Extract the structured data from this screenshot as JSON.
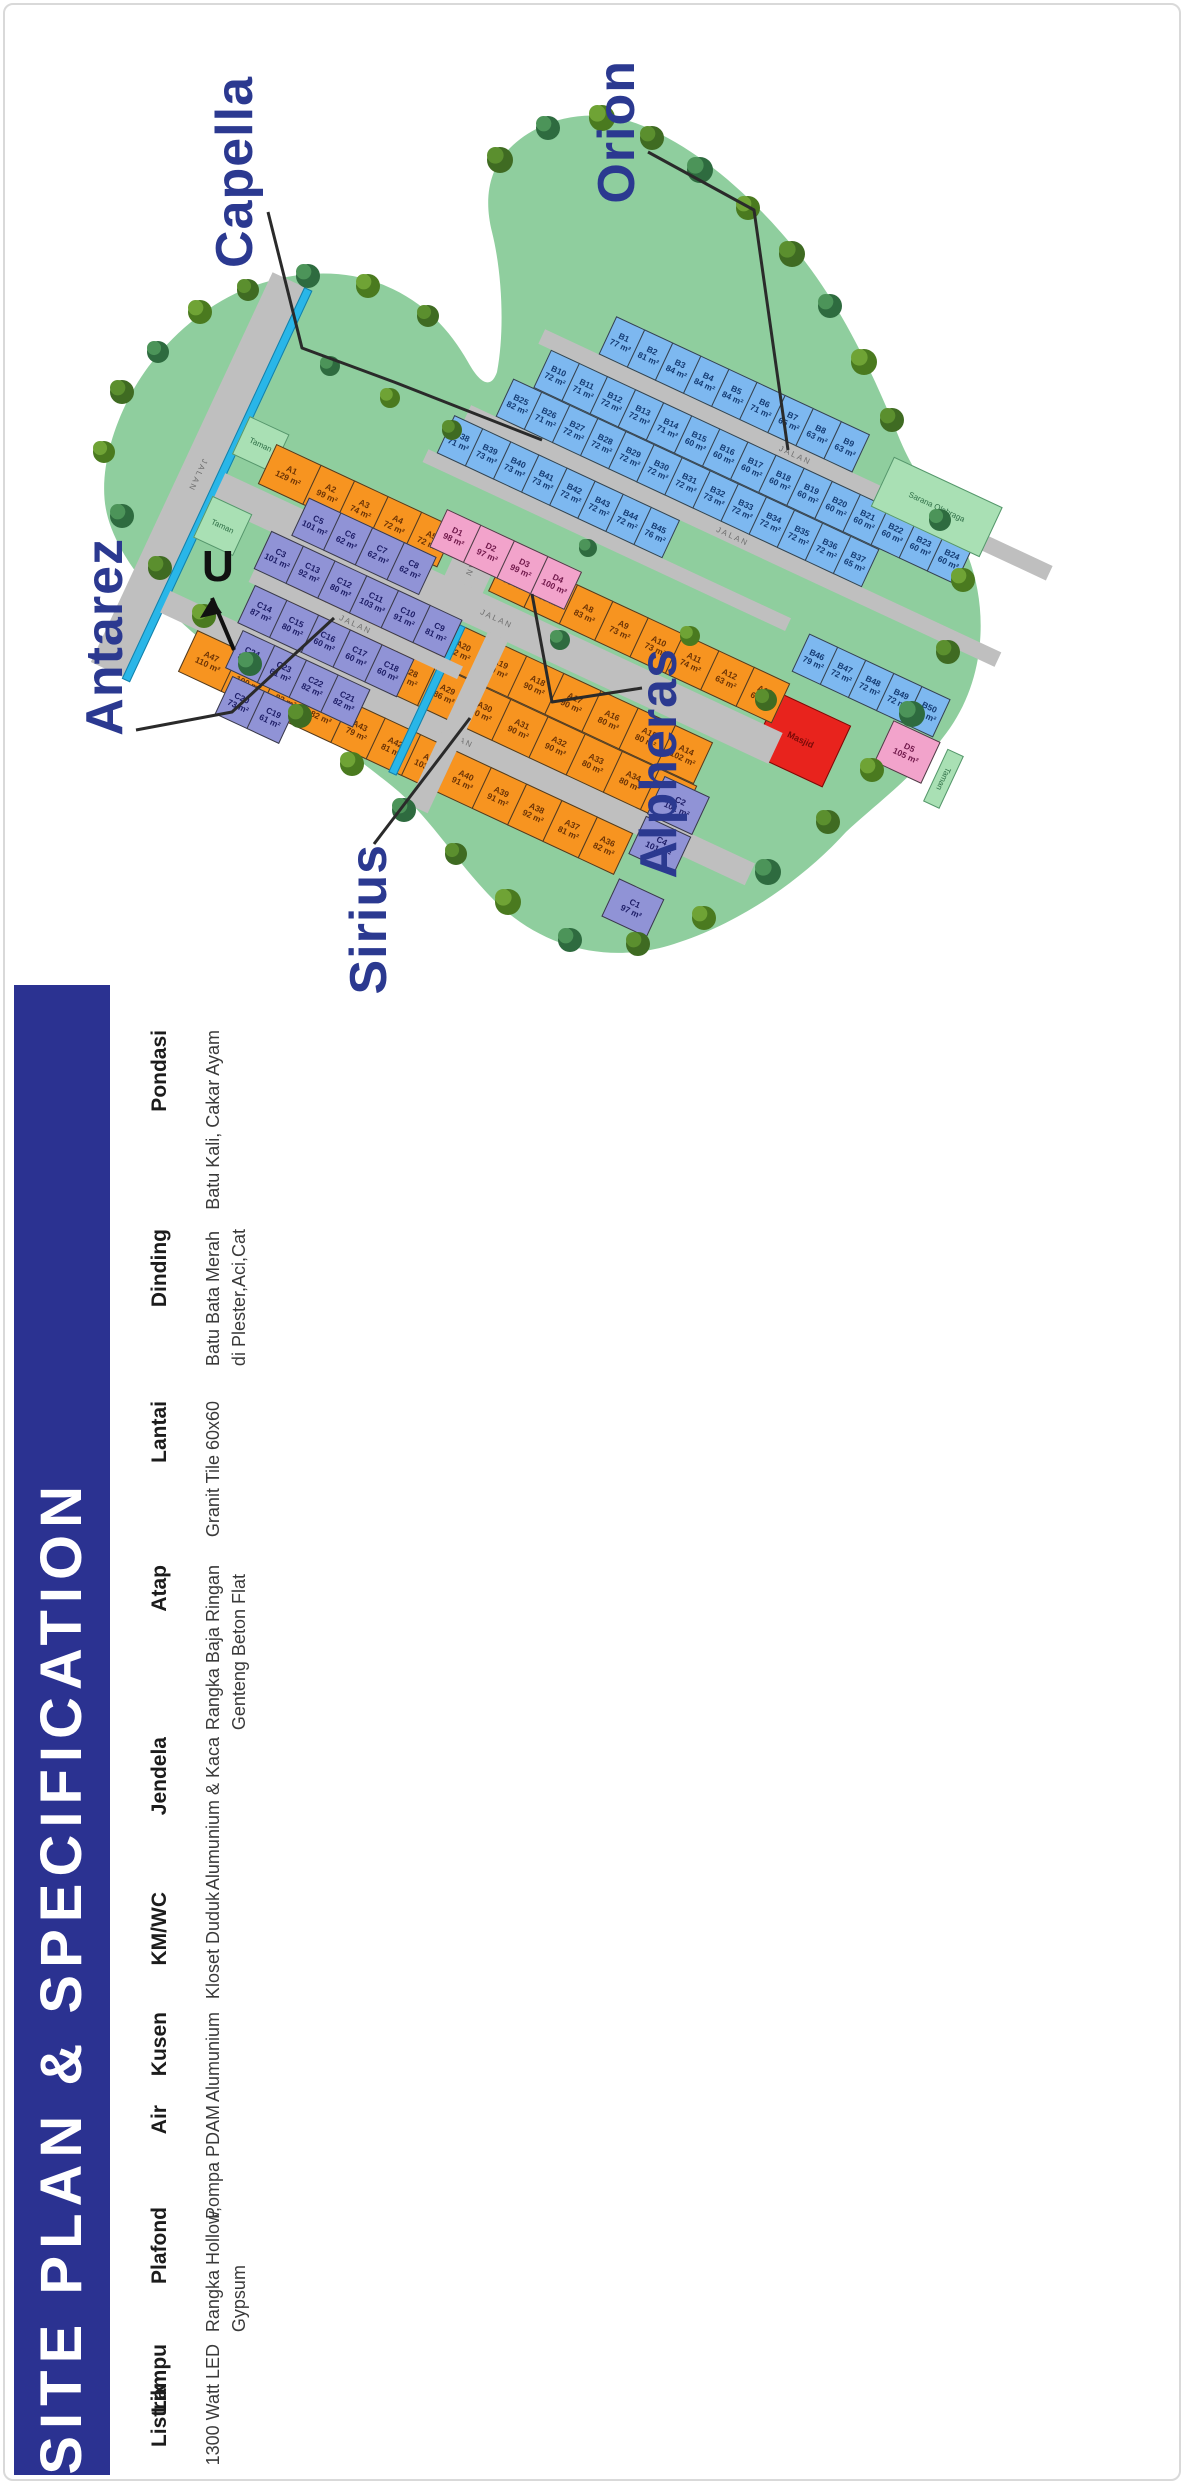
{
  "banner": {
    "title": "SITE PLAN  &  SPECIFICATION",
    "bg": "#2B3291",
    "color": "#ffffff"
  },
  "specifications": [
    {
      "label": "Pondasi",
      "lines": [
        "Batu Kali, Cakar Ayam"
      ]
    },
    {
      "label": "Dinding",
      "lines": [
        "Batu Bata Merah",
        "di Plester,Aci,Cat"
      ]
    },
    {
      "label": "Lantai",
      "lines": [
        "Granit Tile 60x60"
      ]
    },
    {
      "label": "Atap",
      "lines": [
        "Rangka Baja Ringan",
        "Genteng Beton Flat"
      ]
    },
    {
      "label": "Jendela",
      "lines": [
        "Alumunium & Kaca"
      ]
    },
    {
      "label": "KM/WC",
      "lines": [
        "Kloset Duduk"
      ]
    },
    {
      "label": "Kusen",
      "lines": [
        "Alumunium"
      ]
    },
    {
      "label": "Air",
      "lines": [
        "Pompa PDAM"
      ]
    },
    {
      "label": "Plafond",
      "lines": [
        "Rangka Hollow,",
        "Gypsum"
      ]
    },
    {
      "label": "Lampu",
      "lines": [
        "LED"
      ]
    },
    {
      "label": "Listrik",
      "lines": [
        "1300 Watt"
      ]
    }
  ],
  "site_plan": {
    "area_labels": [
      "Capella",
      "Orion",
      "Antarez",
      "Alpheras",
      "Sirius"
    ],
    "north_label": "U",
    "road_label": "JALAN",
    "park_label": "Taman",
    "sport_area_label": "Sarana Olahraga",
    "mosque_label": "Masjid",
    "unit": "m²",
    "colors": {
      "zone_a": "#F79420",
      "zone_b": "#7DB8F0",
      "zone_c": "#9093D6",
      "zone_d": "#F2A3CB",
      "mosque": "#E8231D",
      "green": "#8FCE9E",
      "road": "#BFBFBF",
      "canal": "#29B6E8",
      "accent": "#2B3990"
    },
    "lot_sizes": {
      "A1": "129",
      "A2": "99",
      "A3": "74",
      "A4": "72",
      "A5": "72",
      "A6": "93",
      "A7": "85",
      "A8": "83",
      "A9": "73",
      "A10": "73",
      "A11": "74",
      "A12": "63",
      "A13": "63",
      "A14": "102",
      "A15": "80",
      "A16": "80",
      "A17": "90",
      "A18": "90",
      "A19": "90",
      "A20": "82",
      "A21": "72",
      "A22": "70",
      "A23": "79",
      "A24": "90",
      "A25": "92",
      "A26": "80",
      "A27": "71",
      "A28": "67",
      "A29": "86",
      "A30": "90",
      "A31": "90",
      "A32": "90",
      "A33": "80",
      "A34": "80",
      "A35": "98",
      "A36": "82",
      "A37": "81",
      "A38": "92",
      "A39": "91",
      "A40": "91",
      "A41": "103",
      "A42": "81",
      "A43": "79",
      "A44": "82",
      "A45": "82",
      "A46": "100",
      "A47": "110",
      "B1": "77",
      "B2": "81",
      "B3": "84",
      "B4": "84",
      "B5": "84",
      "B6": "71",
      "B7": "65",
      "B8": "63",
      "B9": "63",
      "B10": "72",
      "B11": "71",
      "B12": "72",
      "B13": "72",
      "B14": "71",
      "B15": "60",
      "B16": "60",
      "B17": "60",
      "B18": "60",
      "B19": "60",
      "B20": "60",
      "B21": "60",
      "B22": "60",
      "B23": "60",
      "B24": "60",
      "B25": "82",
      "B26": "71",
      "B27": "72",
      "B28": "72",
      "B29": "72",
      "B30": "72",
      "B31": "72",
      "B32": "73",
      "B33": "72",
      "B34": "72",
      "B35": "72",
      "B36": "72",
      "B37": "65",
      "B38": "71",
      "B39": "73",
      "B40": "73",
      "B41": "73",
      "B42": "72",
      "B43": "72",
      "B44": "72",
      "B45": "76",
      "B46": "79",
      "B47": "72",
      "B48": "72",
      "B49": "72",
      "B50": "73",
      "C1": "97",
      "C2": "101",
      "C3": "101",
      "C4": "101",
      "C5": "101",
      "C6": "62",
      "C7": "62",
      "C8": "62",
      "C9": "81",
      "C10": "91",
      "C11": "103",
      "C12": "80",
      "C13": "92",
      "C14": "87",
      "C15": "80",
      "C16": "60",
      "C17": "60",
      "C18": "60",
      "C19": "61",
      "C20": "73",
      "C21": "82",
      "C22": "82",
      "C23": "61",
      "C24": "82",
      "D1": "98",
      "D2": "97",
      "D3": "99",
      "D4": "100",
      "D5": "105"
    }
  }
}
